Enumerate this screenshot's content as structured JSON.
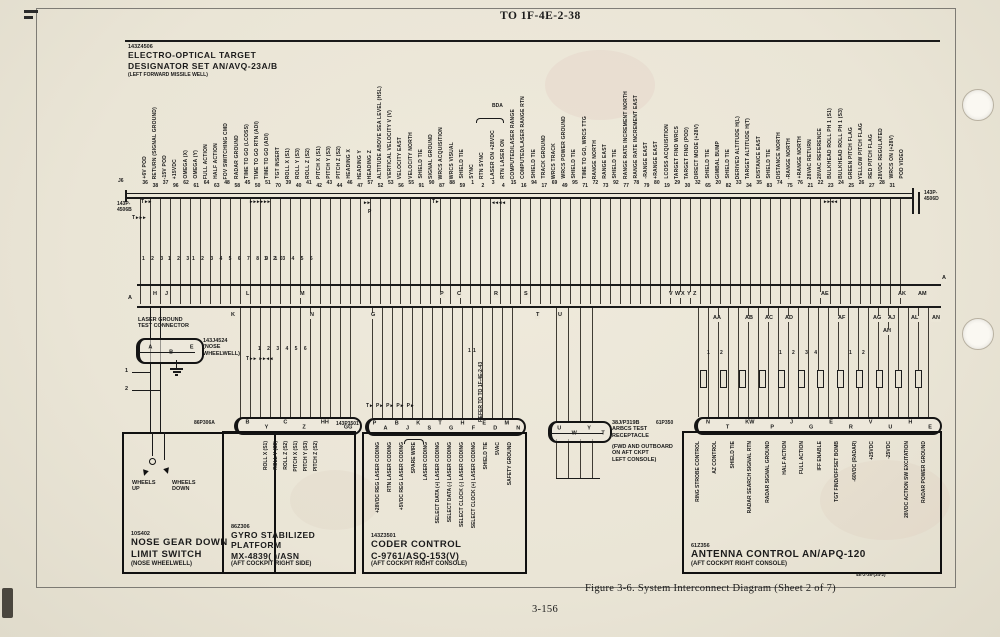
{
  "page": {
    "header": "TO 1F-4E-2-38",
    "figure_caption": "Figure 3-6. System Interconnect Diagram (Sheet 2 of 7)",
    "page_number": "3-156",
    "ref_number": "4E-2-38-(34-2)"
  },
  "designator_set": {
    "id": "143Z4506",
    "name_line1": "ELECTRO-OPTICAL TARGET",
    "name_line2": "DESIGNATOR SET AN/AVQ-23A/B",
    "location": "(LEFT FORWARD MISSILE WELL)",
    "jack_label": "J6",
    "connector_left_l1": "143P-",
    "connector_left_l2": "4506B",
    "connector_right_l1": "143P-",
    "connector_right_l2": "4506D",
    "bda_label": "BDA",
    "pins": [
      {
        "num": "36",
        "label": "+6V POD"
      },
      {
        "num": "38",
        "label": "RETURN (SIGNAL GROUND)"
      },
      {
        "num": "37",
        "label": "-15V POD"
      },
      {
        "num": "96",
        "label": "+15VDC"
      },
      {
        "num": "62",
        "label": "OMEGA (X)"
      },
      {
        "num": "61",
        "label": "OMEGA (Y)"
      },
      {
        "num": "64",
        "label": "FULL ACTION"
      },
      {
        "num": "63",
        "label": "HALF ACTION"
      },
      {
        "num": "48",
        "label": "FOV SWITCHING CMD"
      },
      {
        "num": "58",
        "label": "RADAR GROUND"
      },
      {
        "num": "45",
        "label": "TIME TO GO (LCOSS)"
      },
      {
        "num": "50",
        "label": "TIME TO GO RTN (ADI)"
      },
      {
        "num": "51",
        "label": "TIME TO GO (ADI)"
      },
      {
        "num": "70",
        "label": "TGT INSERT"
      },
      {
        "num": "39",
        "label": "ROLL X (S1)"
      },
      {
        "num": "40",
        "label": "ROLL Y (S3)"
      },
      {
        "num": "41",
        "label": "ROLL Z (S2)"
      },
      {
        "num": "42",
        "label": "PITCH X (S1)"
      },
      {
        "num": "43",
        "label": "PITCH Y (S3)"
      },
      {
        "num": "44",
        "label": "PITCH Z (S2)"
      },
      {
        "num": "46",
        "label": "HEADING X"
      },
      {
        "num": "47",
        "label": "HEADING Y"
      },
      {
        "num": "57",
        "label": "HEADING Z"
      },
      {
        "num": "52",
        "label": "ALTITUDE ABOVE SEA LEVEL (HSL)"
      },
      {
        "num": "53",
        "label": "VERTICAL VELOCITY V (V)"
      },
      {
        "num": "56",
        "label": "VELOCITY EAST"
      },
      {
        "num": "55",
        "label": "VELOCITY NORTH"
      },
      {
        "num": "91",
        "label": "SHIELD TIE"
      },
      {
        "num": "90",
        "label": "SIGNAL GROUND"
      },
      {
        "num": "87",
        "label": "WRCS ACQUISITION"
      },
      {
        "num": "88",
        "label": "WRCS VISUAL"
      },
      {
        "num": "59",
        "label": "SHIELD TIE"
      },
      {
        "num": "1",
        "label": "SYNC"
      },
      {
        "num": "2",
        "label": "RTN SYNC"
      },
      {
        "num": "3",
        "label": "LASER ON +28VDC"
      },
      {
        "num": "4",
        "label": "RTN LASER ON"
      },
      {
        "num": "15",
        "label": "COMPUTED/LASER RANGE"
      },
      {
        "num": "16",
        "label": "COMPUTED/LASER RANGE RTN"
      },
      {
        "num": "94",
        "label": "SHIELD TIE"
      },
      {
        "num": "17",
        "label": "TRACK GROUND"
      },
      {
        "num": "69",
        "label": "WRCS TRACK"
      },
      {
        "num": "49",
        "label": "WRCS POWER GROUND"
      },
      {
        "num": "95",
        "label": "SHIELD TIE"
      },
      {
        "num": "71",
        "label": "TIME TO GO, WRCS TTG"
      },
      {
        "num": "72",
        "label": "RANGE NORTH"
      },
      {
        "num": "73",
        "label": "RANGE EAST"
      },
      {
        "num": "92",
        "label": "SHIELD TIE"
      },
      {
        "num": "77",
        "label": "RANGE RATE INCREMENT NORTH"
      },
      {
        "num": "78",
        "label": "RANGE RATE INCREMENT EAST"
      },
      {
        "num": "79",
        "label": "-RANGE EAST"
      },
      {
        "num": "80",
        "label": "+RANGE EAST"
      },
      {
        "num": "19",
        "label": "LCOSS ACQUISITION"
      },
      {
        "num": "29",
        "label": "TARGET FIND WRCS"
      },
      {
        "num": "30",
        "label": "TARGET FIND (POD)"
      },
      {
        "num": "32",
        "label": "DIRECT MODE (+28V)"
      },
      {
        "num": "65",
        "label": "SHIELD TIE"
      },
      {
        "num": "20",
        "label": "GIMBAL BUMP"
      },
      {
        "num": "82",
        "label": "SHIELD TIE"
      },
      {
        "num": "33",
        "label": "DERIVED ALTITUDE H(L)"
      },
      {
        "num": "34",
        "label": "TARGET ALTITUDE H(T)"
      },
      {
        "num": "35",
        "label": "DISTANCE EAST"
      },
      {
        "num": "83",
        "label": "SHIELD TIE"
      },
      {
        "num": "74",
        "label": "DISTANCE NORTH"
      },
      {
        "num": "75",
        "label": "-RANGE NORTH"
      },
      {
        "num": "76",
        "label": "+RANGE NORTH"
      },
      {
        "num": "21",
        "label": "28VAC RETURN"
      },
      {
        "num": "22",
        "label": "28VAC REFERENCE"
      },
      {
        "num": "23",
        "label": "BULKHEAD ROLL PH 1 (S1)"
      },
      {
        "num": "24",
        "label": "BULKHEAD ROLL PH 1 (S3)"
      },
      {
        "num": "25",
        "label": "GREEN PITCH FLAG"
      },
      {
        "num": "26",
        "label": "YELLOW PITCH FLAG"
      },
      {
        "num": "27",
        "label": "RED PITCH FLAG"
      },
      {
        "num": "28",
        "label": "28VDC REGULATED"
      },
      {
        "num": "31",
        "label": "WRCS ON (+28V)"
      },
      {
        "num": "",
        "label": "POD VIDEO"
      }
    ]
  },
  "refer_note": "REFER TO TO 1F-4E-2-43",
  "bus_letters": {
    "left_end": "A",
    "right_end": "A",
    "above": [
      "H",
      "J",
      "L",
      "M",
      "P",
      "C",
      "R",
      "S",
      "V",
      "W",
      "X",
      "Y",
      "Z",
      "AE",
      "AK",
      "AM"
    ],
    "below": [
      "K",
      "N",
      "G",
      "T",
      "U",
      "AA",
      "AB",
      "AC",
      "AD",
      "AF",
      "AG",
      "AJ",
      "AH",
      "AL",
      "AN"
    ]
  },
  "wire_numbers": {
    "groups": [
      "1 2 3",
      "1 2 3",
      "1 2 3 4 5 6 7 8 9 10",
      "1 2 3 4 5 6",
      "1 2 3 4 5 6",
      "11",
      "1  2",
      "1  2  3 4",
      "1  2"
    ]
  },
  "diode_marks": [
    "T▸▸",
    "T▸▸▸",
    "▸▸▸▸▸▸",
    "▸▸",
    "P",
    "T▸",
    "◂◂◂◂",
    "▸▸◂◂",
    "T▸▸ ▸▸◂◂",
    "T▸ P▸ P▸ P▸ P▸"
  ],
  "laser_ground_connector": {
    "title_line1": "LASER GROUND",
    "title_line2": "TEST CONNECTOR",
    "id": "143J4524",
    "location_line1": "(NOSE",
    "location_line2": "WHEELWELL)",
    "pins": [
      "A",
      "B",
      "E"
    ],
    "wire_label_1": "1",
    "wire_label_2": "2"
  },
  "nose_gear_switch": {
    "id": "10S402",
    "title_line1": "NOSE GEAR DOWN",
    "title_line2": "LIMIT SWITCH",
    "location": "(NOSE WHEELWELL)",
    "wheels_up": "WHEELS UP",
    "wheels_down": "WHEELS DOWN"
  },
  "gyro_platform": {
    "connector": "86P306A",
    "connector_pins": [
      "B",
      "Y",
      "C",
      "Z",
      "HH",
      "GG"
    ],
    "signals": [
      "ROLL X (S1)",
      "ROLL Y (S3)",
      "ROLL Z (S2)",
      "PITCH X (S1)",
      "PITCH Y (S3)",
      "PITCH Z (S2)"
    ],
    "id": "86Z306",
    "title": "GYRO STABILIZED PLATFORM",
    "model": "MX-4839( )/ASN",
    "location": "(AFT COCKPIT RIGHT SIDE)"
  },
  "coder_control": {
    "connector": "143P3501",
    "connector_pins": [
      "P",
      "A",
      "B",
      "J",
      "K",
      "S",
      "T",
      "G",
      "H",
      "F",
      "E",
      "D",
      "M",
      "N"
    ],
    "signals": [
      "+28VDC REG LASER CODING",
      "RTN LASER CODING",
      "+5VDC REG LASER CODING",
      "SPARE WIRE",
      "LASER CODING",
      "SELECT DATA (+) LASER CODING",
      "SELECT DATA (-) LASER CODING",
      "SELECT CLOCK (-) LASER CODING",
      "SELECT CLOCK (+) LASER CODING",
      "SHIELD TIE",
      "5VAC",
      "SAFETY GROUND"
    ],
    "id": "143Z3501",
    "title": "CODER CONTROL",
    "model": "C-9761/ASQ-153(V)",
    "location": "(AFT COCKPIT RIGHT CONSOLE)"
  },
  "arbcs_receptacle": {
    "pins": [
      "U",
      "W",
      "Y",
      "T"
    ],
    "id": "38J/P319B",
    "title_line1": "ARBCS TEST",
    "title_line2": "RECEPTACLE",
    "location_line1": "(FWD AND OUTBOARD",
    "location_line2": "ON AFT CKPT",
    "location_line3": "LEFT CONSOLE)"
  },
  "antenna_control": {
    "connector": "61P350",
    "connector_pins": [
      "N",
      "T",
      "KW",
      "P",
      "J",
      "G",
      "E",
      "R",
      "V",
      "U",
      "H",
      "E"
    ],
    "signals": [
      "RING STROBE CONTROL",
      "AZ CONTROL",
      "SHIELD TIE",
      "RADAR SEARCH SIGNAL RTN",
      "RADAR SIGNAL GROUND",
      "HALF ACTION",
      "FULL ACTION",
      "IFF ENABLE",
      "TGT FIND/OFFSET BOMB",
      "-60VDC (RADAR)",
      "+25VDC",
      "-25VDC",
      "28VDC ACTION SW EXCITATION",
      "RADAR POWER GROUND"
    ],
    "id": "61Z356",
    "title": "ANTENNA CONTROL AN/APQ-120",
    "location": "(AFT COCKPIT RIGHT CONSOLE)"
  }
}
